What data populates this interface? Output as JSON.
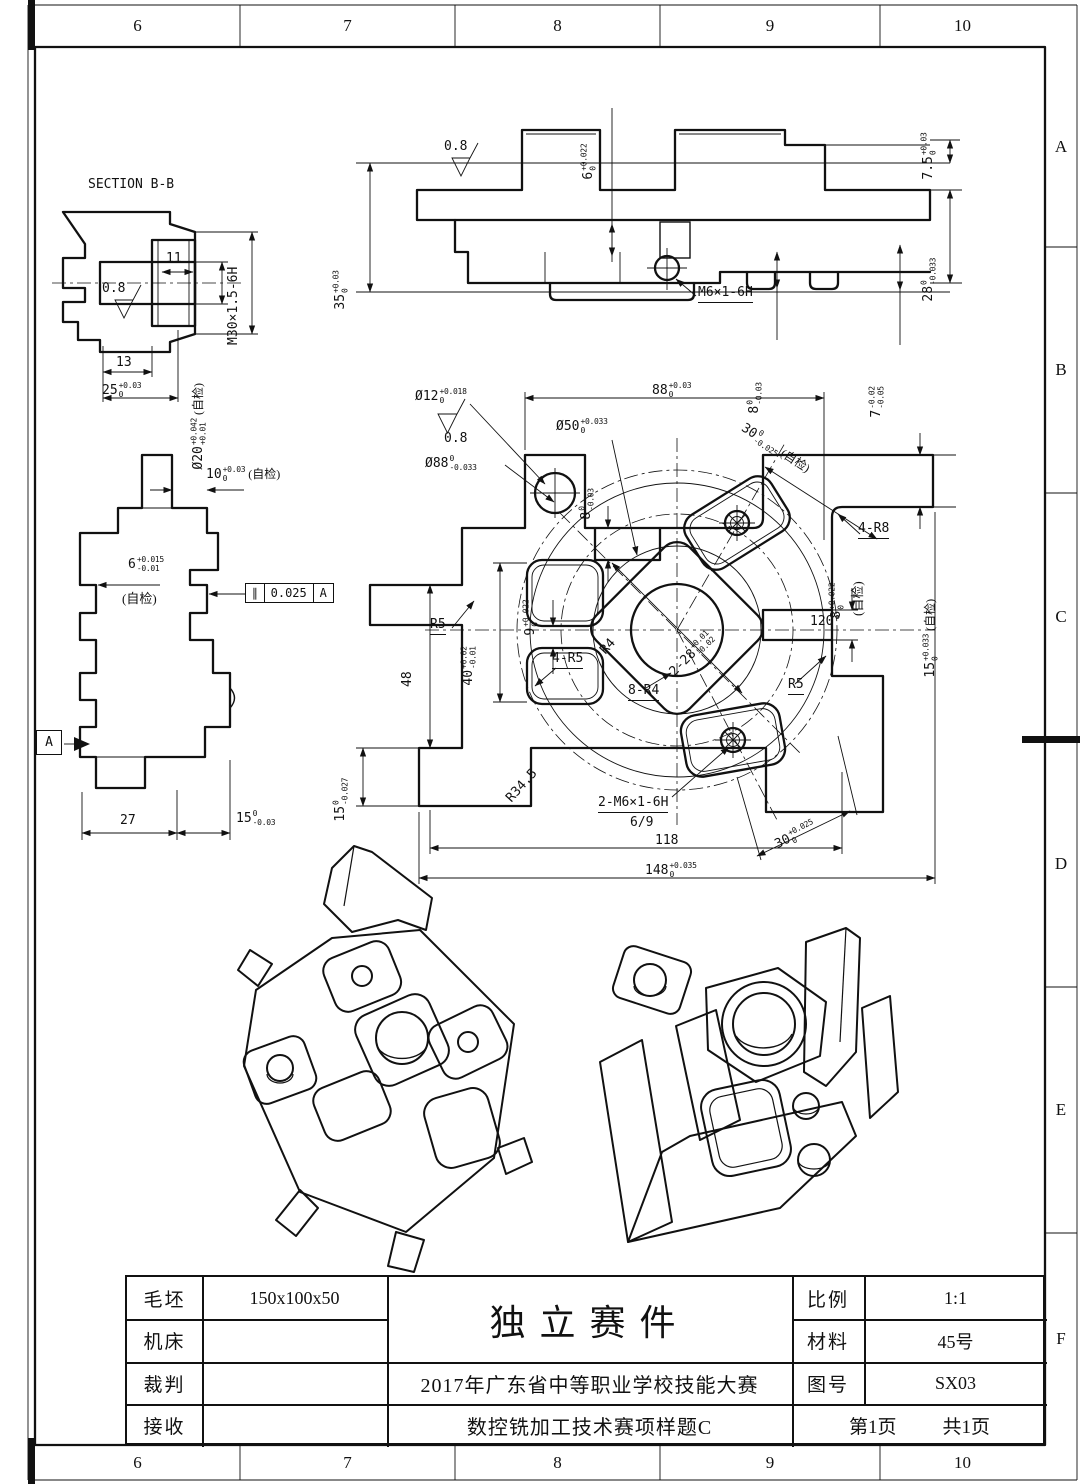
{
  "border": {
    "columns": [
      "6",
      "7",
      "8",
      "9",
      "10"
    ],
    "rows": [
      "A",
      "B",
      "C",
      "D",
      "E",
      "F"
    ]
  },
  "views": {
    "section_bb": {
      "title": "SECTION B-B",
      "dims": {
        "d11": {
          "v": "11"
        },
        "rough": {
          "v": "0.8"
        },
        "m30": {
          "v": "M30×1.5-6H"
        },
        "d13": {
          "v": "13"
        },
        "d25": {
          "v": "25",
          "sup": "+0.03",
          "sub": "0"
        },
        "d20": {
          "v": "Ø20",
          "sup": "+0.042",
          "sub": "+0.01",
          "post": "(自检)"
        }
      }
    },
    "front": {
      "dims": {
        "rough": {
          "v": "0.8"
        },
        "d6": {
          "v": "6",
          "sup": "+0.022",
          "sub": "0"
        },
        "d35": {
          "v": "35",
          "sup": "+0.03",
          "sub": "0"
        },
        "d75": {
          "v": "7.5",
          "sup": "+0.03",
          "sub": "0"
        },
        "d28": {
          "v": "28",
          "sup": "0",
          "sub": "-0.033"
        },
        "m6": {
          "v": "M6×1-6H"
        },
        "d8": {
          "v": "8",
          "sup": "0",
          "sub": "-0.03"
        },
        "d7": {
          "v": "7",
          "sup": "-0.02",
          "sub": "-0.05"
        }
      }
    },
    "side": {
      "dims": {
        "d10": {
          "v": "10",
          "sup": "+0.03",
          "sub": "0",
          "post": "(自检)"
        },
        "d6": {
          "v": "6",
          "sup": "+0.015",
          "sub": "-0.01"
        },
        "zj": {
          "v": "(自检)"
        },
        "d27": {
          "v": "27"
        },
        "d15": {
          "v": "15",
          "sup": "0",
          "sub": "-0.03"
        }
      },
      "fcf": {
        "sym": "∥",
        "tol": "0.025",
        "datum": "A"
      },
      "datum": "A"
    },
    "plan": {
      "dims": {
        "d12": {
          "v": "Ø12",
          "sup": "+0.018",
          "sub": "0"
        },
        "rough": {
          "v": "0.8"
        },
        "d88": {
          "v": "Ø88",
          "sup": "0",
          "sub": "-0.033"
        },
        "d50": {
          "v": "Ø50",
          "sup": "+0.033",
          "sub": "0"
        },
        "d88w": {
          "v": "88",
          "sup": "+0.03",
          "sub": "0"
        },
        "d8top": {
          "v": "8",
          "sup": "0",
          "sub": "-0.03"
        },
        "d30t": {
          "v": "30",
          "sup": "0",
          "sub": "-0.025",
          "post": "(自检)"
        },
        "r8": {
          "v": "4-R8"
        },
        "d8r": {
          "v": "8",
          "sup": "+0.022",
          "sub": "0"
        },
        "zj1": {
          "v": "(自检)"
        },
        "d15r": {
          "v": "15",
          "sup": "+0.033",
          "sub": "0",
          "post": "(自检)"
        },
        "a120": {
          "v": "120°"
        },
        "r5a": {
          "v": "R5"
        },
        "r5b": {
          "v": "R5"
        },
        "d9": {
          "v": "9",
          "sup": "+0.022",
          "sub": "0"
        },
        "d40": {
          "v": "40",
          "sup": "+0.02",
          "sub": "-0.01"
        },
        "r4": {
          "v": "R4"
        },
        "r45": {
          "v": "4-R5"
        },
        "d28": {
          "v": "2-28",
          "sup": "+0.01",
          "sub": "-0.02"
        },
        "r84": {
          "v": "8-R4"
        },
        "r345": {
          "v": "R34.5"
        },
        "m62": {
          "v": "2-M6×1-6H"
        },
        "depth": {
          "v": "6/9"
        },
        "d30b": {
          "v": "30",
          "sup": "+0.025",
          "sub": "0"
        },
        "d118": {
          "v": "118"
        },
        "d148": {
          "v": "148",
          "sup": "+0.035",
          "sub": "0"
        },
        "d48": {
          "v": "48"
        },
        "d15b": {
          "v": "15",
          "sup": "0",
          "sub": "-0.027"
        }
      }
    }
  },
  "title_block": {
    "left_rows": [
      {
        "label": "毛坯",
        "value": "150x100x50"
      },
      {
        "label": "机床",
        "value": ""
      },
      {
        "label": "裁判",
        "value": ""
      },
      {
        "label": "接收",
        "value": ""
      }
    ],
    "part_title": "独立赛件",
    "event_line1": "2017年广东省中等职业学校技能大赛",
    "event_line2": "数控铣加工技术赛项样题C",
    "right_rows": [
      {
        "label": "比例",
        "value": "1:1"
      },
      {
        "label": "材料",
        "value": "45号"
      },
      {
        "label": "图号",
        "value": "SX03"
      }
    ],
    "page": "第1页",
    "pages_total": "共1页"
  }
}
